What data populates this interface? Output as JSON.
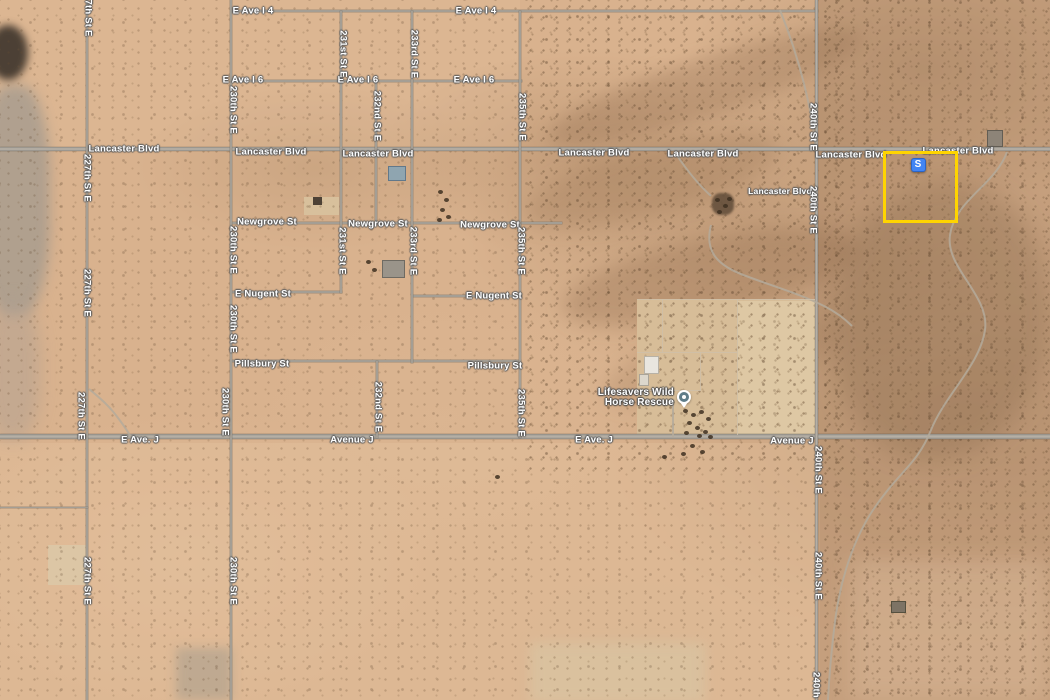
{
  "map": {
    "colors": {
      "terrain_base": "#D9B28E",
      "parcel_highlight": "#FFD400",
      "marker_blue": "#4285F4",
      "road_gray": "#A49E94",
      "label_white": "#FFFFFF"
    },
    "marker": {
      "label": "S"
    },
    "poi": {
      "line1": "Lifesavers Wild",
      "line2": "Horse Rescue"
    },
    "roads": [
      {
        "n": "e-ave-i-4",
        "o": "h",
        "x": 232,
        "y": 11,
        "l": 586,
        "w": 2
      },
      {
        "n": "e-ave-i-6",
        "o": "h",
        "x": 232,
        "y": 81,
        "l": 290,
        "w": 2
      },
      {
        "n": "lancaster-blvd",
        "o": "h",
        "x": 0,
        "y": 149,
        "l": 1050,
        "w": 4,
        "major": 1
      },
      {
        "n": "newgrove-st",
        "o": "h",
        "x": 232,
        "y": 223,
        "l": 330,
        "w": 2
      },
      {
        "n": "e-nugent-st-west",
        "o": "h",
        "x": 232,
        "y": 292,
        "l": 110,
        "w": 2
      },
      {
        "n": "e-nugent-st-east",
        "o": "h",
        "x": 412,
        "y": 296,
        "l": 110,
        "w": 2
      },
      {
        "n": "pillsbury-st",
        "o": "h",
        "x": 232,
        "y": 361,
        "l": 289,
        "w": 2
      },
      {
        "n": "avenue-j",
        "o": "h",
        "x": 0,
        "y": 436,
        "l": 1050,
        "w": 5,
        "major": 1
      },
      {
        "n": "227th-st-e",
        "o": "v",
        "x": 87,
        "y": 0,
        "l": 700,
        "w": 2
      },
      {
        "n": "230th-st-e",
        "o": "v",
        "x": 231,
        "y": 0,
        "l": 700,
        "w": 2
      },
      {
        "n": "231st-st-e",
        "o": "v",
        "x": 341,
        "y": 11,
        "l": 282,
        "w": 2
      },
      {
        "n": "232nd-st-e-north",
        "o": "v",
        "x": 376,
        "y": 81,
        "l": 143,
        "w": 2
      },
      {
        "n": "232nd-st-e-south",
        "o": "v",
        "x": 377,
        "y": 361,
        "l": 77,
        "w": 2
      },
      {
        "n": "233rd-st-e",
        "o": "v",
        "x": 412,
        "y": 11,
        "l": 352,
        "w": 2
      },
      {
        "n": "235th-st-e",
        "o": "v",
        "x": 520,
        "y": 11,
        "l": 427,
        "w": 2
      },
      {
        "n": "240th-st-e",
        "o": "v",
        "x": 816,
        "y": 0,
        "l": 700,
        "w": 3,
        "major": 1
      },
      {
        "n": "field-line",
        "o": "h",
        "x": 0,
        "y": 507,
        "l": 88,
        "w": 1
      }
    ],
    "road_labels": [
      {
        "t": "E Ave I 4",
        "x": 253,
        "y": 11
      },
      {
        "t": "E Ave I 4",
        "x": 476,
        "y": 11
      },
      {
        "t": "E Ave I 6",
        "x": 243,
        "y": 80
      },
      {
        "t": "E Ave I 6",
        "x": 358,
        "y": 80
      },
      {
        "t": "E Ave I 6",
        "x": 474,
        "y": 80
      },
      {
        "t": "Lancaster Blvd",
        "x": 124,
        "y": 149
      },
      {
        "t": "Lancaster Blvd",
        "x": 271,
        "y": 152
      },
      {
        "t": "Lancaster Blvd",
        "x": 378,
        "y": 154
      },
      {
        "t": "Lancaster Blvd",
        "x": 594,
        "y": 153
      },
      {
        "t": "Lancaster Blvd",
        "x": 703,
        "y": 154
      },
      {
        "t": "Lancaster Blvd",
        "x": 851,
        "y": 155
      },
      {
        "t": "Lancaster Blvd",
        "x": 958,
        "y": 151
      },
      {
        "t": "Lancaster Blvd",
        "x": 780,
        "y": 191,
        "s": 8.5
      },
      {
        "t": "Newgrove St",
        "x": 267,
        "y": 222
      },
      {
        "t": "Newgrove St",
        "x": 378,
        "y": 224
      },
      {
        "t": "Newgrove St",
        "x": 490,
        "y": 225
      },
      {
        "t": "E Nugent St",
        "x": 263,
        "y": 294
      },
      {
        "t": "E Nugent St",
        "x": 494,
        "y": 296
      },
      {
        "t": "Pillsbury St",
        "x": 262,
        "y": 364
      },
      {
        "t": "Pillsbury St",
        "x": 495,
        "y": 366
      },
      {
        "t": "E Ave. J",
        "x": 140,
        "y": 440
      },
      {
        "t": "Avenue J",
        "x": 352,
        "y": 440
      },
      {
        "t": "E Ave. J",
        "x": 594,
        "y": 440
      },
      {
        "t": "Avenue J",
        "x": 792,
        "y": 441
      },
      {
        "t": "7th St E",
        "x": 88,
        "y": 18,
        "v": 1
      },
      {
        "t": "227th St E",
        "x": 87,
        "y": 178,
        "v": 1
      },
      {
        "t": "227th St E",
        "x": 87,
        "y": 293,
        "v": 1
      },
      {
        "t": "227th St E",
        "x": 81,
        "y": 416,
        "v": 1
      },
      {
        "t": "227th St E",
        "x": 87,
        "y": 581,
        "v": 1
      },
      {
        "t": "230th St E",
        "x": 233,
        "y": 110,
        "v": 1
      },
      {
        "t": "230th St E",
        "x": 233,
        "y": 250,
        "v": 1
      },
      {
        "t": "230th St E",
        "x": 233,
        "y": 329,
        "v": 1
      },
      {
        "t": "230th St E",
        "x": 225,
        "y": 412,
        "v": 1
      },
      {
        "t": "230th St E",
        "x": 233,
        "y": 581,
        "v": 1
      },
      {
        "t": "231st St E",
        "x": 343,
        "y": 54,
        "v": 1
      },
      {
        "t": "231st St E",
        "x": 342,
        "y": 251,
        "v": 1
      },
      {
        "t": "232nd St E",
        "x": 377,
        "y": 116,
        "v": 1
      },
      {
        "t": "232nd St E",
        "x": 378,
        "y": 407,
        "v": 1
      },
      {
        "t": "233rd St E",
        "x": 414,
        "y": 54,
        "v": 1
      },
      {
        "t": "233rd St E",
        "x": 413,
        "y": 251,
        "v": 1
      },
      {
        "t": "235th St E",
        "x": 522,
        "y": 117,
        "v": 1
      },
      {
        "t": "235th St E",
        "x": 521,
        "y": 251,
        "v": 1
      },
      {
        "t": "235th St E",
        "x": 521,
        "y": 413,
        "v": 1
      },
      {
        "t": "240th St E",
        "x": 813,
        "y": 127,
        "v": 1
      },
      {
        "t": "240th St E",
        "x": 813,
        "y": 210,
        "v": 1
      },
      {
        "t": "240th St E",
        "x": 818,
        "y": 470,
        "v": 1
      },
      {
        "t": "240th St E",
        "x": 818,
        "y": 576,
        "v": 1
      },
      {
        "t": "240th St E",
        "x": 816,
        "y": 696,
        "v": 1
      }
    ],
    "patches": [
      {
        "n": "terrain-light-northwest",
        "x": 0,
        "y": 0,
        "w": 520,
        "h": 150,
        "c": "rgba(232,199,164,.18)"
      },
      {
        "n": "terrain-south-light",
        "x": 0,
        "y": 443,
        "w": 820,
        "h": 257,
        "c": "rgba(235,202,167,.25)"
      },
      {
        "n": "terrain-east-dark-column",
        "x": 818,
        "y": 0,
        "w": 232,
        "h": 700,
        "c": "rgba(151,117,85,.30)"
      },
      {
        "n": "terrain-gray-west",
        "x": -20,
        "y": 85,
        "w": 70,
        "h": 230,
        "c": "rgba(165,155,142,.8)",
        "blur": 6,
        "rad": 40
      },
      {
        "n": "terrain-dark-blob",
        "x": -12,
        "y": 25,
        "w": 40,
        "h": 55,
        "c": "rgba(50,44,36,.85)",
        "blur": 4,
        "rad": 50
      },
      {
        "n": "terrain-gray-west-2",
        "x": -15,
        "y": 300,
        "w": 55,
        "h": 140,
        "c": "rgba(175,160,145,.5)",
        "blur": 8,
        "rad": 40
      },
      {
        "n": "field-square-light",
        "x": 48,
        "y": 545,
        "w": 38,
        "h": 40,
        "c": "rgba(219,200,166,.9)",
        "rad": 2
      },
      {
        "n": "terrain-gray-bottom",
        "x": 176,
        "y": 648,
        "w": 56,
        "h": 52,
        "c": "rgba(170,158,142,.6)",
        "blur": 5
      },
      {
        "n": "terrain-tan-bottom-middle",
        "x": 530,
        "y": 643,
        "w": 175,
        "h": 60,
        "c": "rgba(216,197,162,.7)",
        "blur": 6
      },
      {
        "n": "wash-band-1",
        "x": 540,
        "y": 58,
        "w": 330,
        "h": 58,
        "c": "rgba(146,110,78,.30)",
        "blur": 8,
        "rot": -18,
        "rad": 50
      },
      {
        "n": "wash-band-2",
        "x": 520,
        "y": 148,
        "w": 260,
        "h": 66,
        "c": "rgba(146,110,78,.25)",
        "blur": 9,
        "rot": -15,
        "rad": 50
      },
      {
        "n": "wash-band-3",
        "x": 560,
        "y": 238,
        "w": 300,
        "h": 78,
        "c": "rgba(140,104,72,.30)",
        "blur": 9,
        "rot": -12,
        "rad": 50
      },
      {
        "n": "wash-band-4",
        "x": 600,
        "y": 328,
        "w": 240,
        "h": 68,
        "c": "rgba(150,114,82,.22)",
        "blur": 9,
        "rot": -15,
        "rad": 50
      },
      {
        "n": "east-ridge-dark",
        "x": 830,
        "y": 180,
        "w": 220,
        "h": 280,
        "c": "rgba(120,90,62,.25)",
        "blur": 12,
        "rot": 8,
        "rad": 60
      },
      {
        "n": "bottom-right-light",
        "x": 850,
        "y": 560,
        "w": 200,
        "h": 140,
        "c": "rgba(226,196,162,.35)",
        "blur": 10
      },
      {
        "n": "ranch-cleared-pad",
        "x": 637,
        "y": 299,
        "w": 178,
        "h": 138,
        "c": "#D7BD98"
      },
      {
        "n": "ranch-cleared-pad-east",
        "x": 737,
        "y": 301,
        "w": 78,
        "h": 134,
        "c": "#DEC8A4"
      },
      {
        "n": "cleared-pad-232nd",
        "x": 304,
        "y": 197,
        "w": 35,
        "h": 18,
        "c": "#D8C09C"
      }
    ],
    "trails": [
      {
        "n": "trail-corner-240th",
        "d": "M780,10 C800,60 812,110 816,150"
      },
      {
        "n": "trail-east-wash",
        "d": "M1007,152 C995,185 955,200 950,235 C945,268 990,295 985,330 C980,365 945,395 931,430 C917,465 900,470 873,510 C850,545 838,590 834,630 C831,655 829,680 828,700"
      },
      {
        "n": "trail-ranch-driveway",
        "d": "M676,154 C688,172 700,186 711,196"
      },
      {
        "n": "trail-ranch-loop",
        "d": "M711,225 C704,252 718,266 746,276 C778,288 800,294 824,306 C836,312 844,318 852,326"
      },
      {
        "n": "trail-southwest",
        "d": "M89,389 C100,398 108,405 115,414 C122,423 127,430 131,437"
      },
      {
        "n": "trail-compound-access",
        "d": "M673,437 L673,403"
      }
    ],
    "fences": [
      {
        "n": "fence-top",
        "x": 637,
        "y": 299,
        "w": 178,
        "h": 1
      },
      {
        "n": "fence-mid",
        "x": 637,
        "y": 352,
        "w": 100,
        "h": 1
      },
      {
        "n": "fence-low",
        "x": 637,
        "y": 390,
        "w": 64,
        "h": 1
      },
      {
        "n": "fence-v1",
        "x": 662,
        "y": 299,
        "w": 1,
        "h": 53
      },
      {
        "n": "fence-v2",
        "x": 700,
        "y": 352,
        "w": 1,
        "h": 38
      },
      {
        "n": "fence-v3",
        "x": 737,
        "y": 299,
        "w": 1,
        "h": 136
      }
    ],
    "structures": [
      {
        "n": "building-blue-roof",
        "x": 388,
        "y": 166,
        "w": 16,
        "h": 13,
        "c": "#8FA5B0",
        "b": "#62788a"
      },
      {
        "n": "building-small-dark",
        "x": 313,
        "y": 197,
        "w": 9,
        "h": 8,
        "c": "#4e4236"
      },
      {
        "n": "building-gray-cluster",
        "x": 382,
        "y": 260,
        "w": 21,
        "h": 16,
        "c": "#9a948a",
        "b": "#6e6a62"
      },
      {
        "n": "homestead-west-of-240th",
        "x": 712,
        "y": 193,
        "w": 22,
        "h": 22,
        "c": "rgba(95,75,56,.85)",
        "rad": 40,
        "blur": 1
      },
      {
        "n": "building-east-of-parcel",
        "x": 987,
        "y": 130,
        "w": 14,
        "h": 15,
        "c": "#8d8478",
        "b": "#635d53"
      },
      {
        "n": "ranch-barn",
        "x": 644,
        "y": 356,
        "w": 13,
        "h": 16,
        "c": "#E9E6DF",
        "b": "#b8b2a6"
      },
      {
        "n": "ranch-shed",
        "x": 639,
        "y": 374,
        "w": 8,
        "h": 10,
        "c": "#DCD7CC",
        "b": "#aaa498"
      },
      {
        "n": "building-south-of-avej",
        "x": 891,
        "y": 601,
        "w": 13,
        "h": 10,
        "c": "#7d7365",
        "b": "#55503f"
      }
    ],
    "tree_dots": [
      [
        438,
        190
      ],
      [
        444,
        198
      ],
      [
        440,
        208
      ],
      [
        446,
        215
      ],
      [
        437,
        218
      ],
      [
        715,
        198
      ],
      [
        723,
        204
      ],
      [
        717,
        210
      ],
      [
        727,
        197
      ],
      [
        683,
        409
      ],
      [
        691,
        413
      ],
      [
        699,
        410
      ],
      [
        706,
        417
      ],
      [
        687,
        421
      ],
      [
        695,
        426
      ],
      [
        703,
        430
      ],
      [
        684,
        431
      ],
      [
        697,
        434
      ],
      [
        708,
        435
      ],
      [
        690,
        444
      ],
      [
        700,
        450
      ],
      [
        681,
        452
      ],
      [
        662,
        455
      ],
      [
        495,
        475
      ],
      [
        366,
        260
      ],
      [
        372,
        268
      ]
    ]
  }
}
